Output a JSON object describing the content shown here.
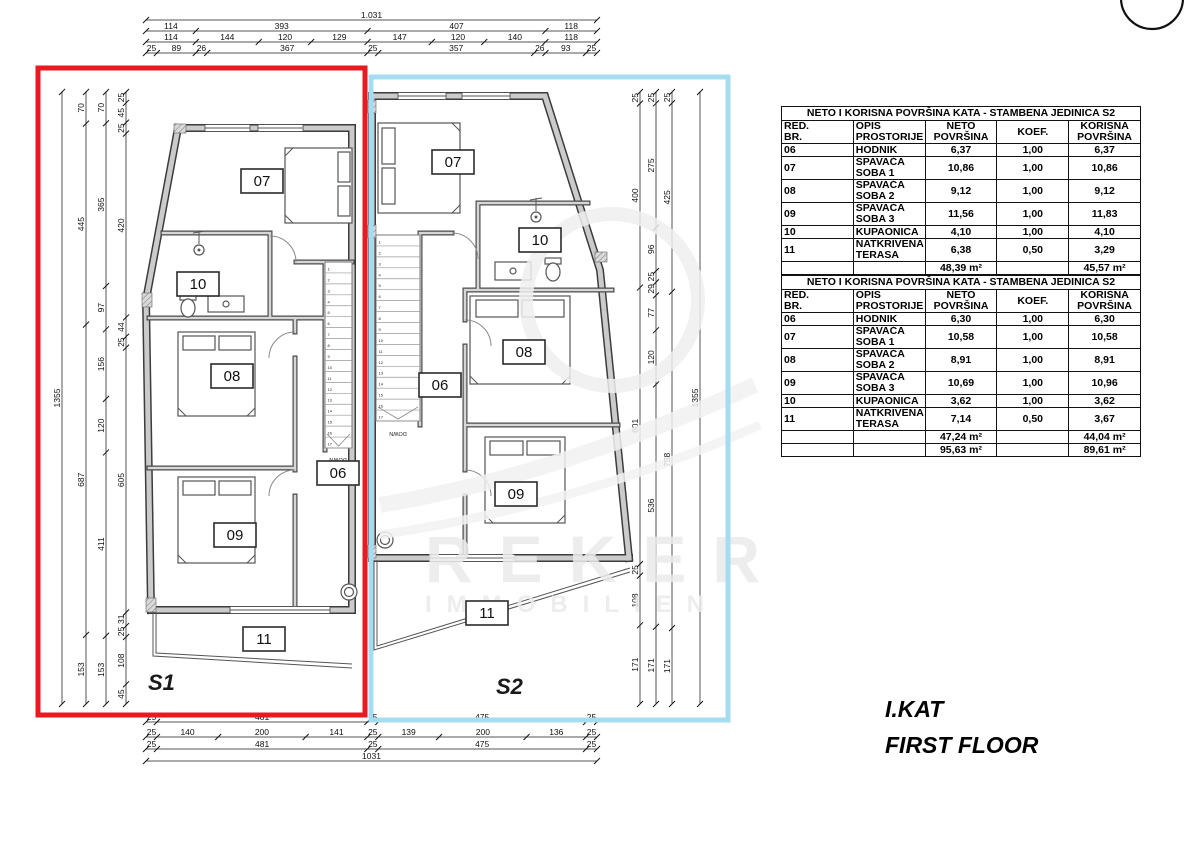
{
  "meta": {
    "sheet_title_hr": "I.KAT",
    "sheet_title_en": "FIRST FLOOR"
  },
  "units": {
    "s1": {
      "label": "S1",
      "color": "#e8191f",
      "rooms": [
        "07",
        "10",
        "08",
        "09",
        "06",
        "11"
      ]
    },
    "s2": {
      "label": "S2",
      "color": "#74cde9",
      "rooms": [
        "07",
        "10",
        "08",
        "09",
        "06",
        "11"
      ]
    }
  },
  "stairs": {
    "treads": 17,
    "down_label": "DOWN"
  },
  "watermark": {
    "line1": "REKER",
    "line2": "IMMOBILIEN"
  },
  "north_icon": "north-arrow",
  "dimensions": {
    "top": [
      [
        "1.031"
      ],
      [
        "114",
        "393",
        "407",
        "118"
      ],
      [
        "114",
        "144",
        "120",
        "129",
        "147",
        "120",
        "140",
        "118"
      ],
      [
        "25",
        "89",
        "26",
        "367",
        "25",
        "357",
        "26",
        "93",
        "25"
      ]
    ],
    "bottom": [
      [
        "25",
        "481",
        "25",
        "475",
        "25"
      ],
      [
        "25",
        "140",
        "200",
        "141",
        "25",
        "139",
        "200",
        "136",
        "25"
      ],
      [
        "25",
        "481",
        "25",
        "475",
        "25"
      ],
      [
        "1031"
      ]
    ],
    "left": [
      [
        "1355"
      ],
      [
        "70",
        "445",
        "687",
        "153"
      ],
      [
        "70",
        "365",
        "97",
        "156",
        "120",
        "411",
        "153"
      ],
      [
        "25",
        "45",
        "25",
        "420",
        "44",
        "25",
        "605",
        "31",
        "25",
        "108",
        "45"
      ]
    ],
    "right": [
      [
        "25",
        "400",
        "601",
        "25",
        "108",
        "171"
      ],
      [
        "25",
        "275",
        "96",
        "25",
        "29",
        "77",
        "120",
        "536",
        "171"
      ],
      [
        "25",
        "425",
        "758",
        "171"
      ],
      [
        "1355"
      ]
    ]
  },
  "tables": [
    {
      "title": "NETO I KORISNA POVRŠINA KATA - STAMBENA JEDINICA S2",
      "headers": [
        "RED.\nBR.",
        "OPIS PROSTORIJE",
        "NETO\nPOVRŠINA",
        "KOEF.",
        "KORISNA\nPOVRŠINA"
      ],
      "rows": [
        [
          "06",
          "HODNIK",
          "6,37",
          "1,00",
          "6,37"
        ],
        [
          "07",
          "SPAVAĆA SOBA 1",
          "10,86",
          "1,00",
          "10,86"
        ],
        [
          "08",
          "SPAVAĆA SOBA 2",
          "9,12",
          "1,00",
          "9,12"
        ],
        [
          "09",
          "SPAVAĆA SOBA 3",
          "11,56",
          "1,00",
          "11,83"
        ],
        [
          "10",
          "KUPAONICA",
          "4,10",
          "1,00",
          "4,10"
        ],
        [
          "11",
          "NATKRIVENA TERASA",
          "6,38",
          "0,50",
          "3,29"
        ]
      ],
      "totals": [
        [
          "48,39 m²",
          "45,57 m²"
        ]
      ]
    },
    {
      "title": "NETO I KORISNA POVRŠINA KATA - STAMBENA JEDINICA S2",
      "headers": [
        "RED.\nBR.",
        "OPIS PROSTORIJE",
        "NETO\nPOVRŠINA",
        "KOEF.",
        "KORISNA\nPOVRŠINA"
      ],
      "rows": [
        [
          "06",
          "HODNIK",
          "6,30",
          "1,00",
          "6,30"
        ],
        [
          "07",
          "SPAVAĆA SOBA 1",
          "10,58",
          "1,00",
          "10,58"
        ],
        [
          "08",
          "SPAVAĆA SOBA 2",
          "8,91",
          "1,00",
          "8,91"
        ],
        [
          "09",
          "SPAVAĆA SOBA 3",
          "10,69",
          "1,00",
          "10,96"
        ],
        [
          "10",
          "KUPAONICA",
          "3,62",
          "1,00",
          "3,62"
        ],
        [
          "11",
          "NATKRIVENA TERASA",
          "7,14",
          "0,50",
          "3,67"
        ]
      ],
      "totals": [
        [
          "47,24 m²",
          "44,04 m²"
        ],
        [
          "95,63 m²",
          "89,61 m²"
        ]
      ]
    }
  ]
}
